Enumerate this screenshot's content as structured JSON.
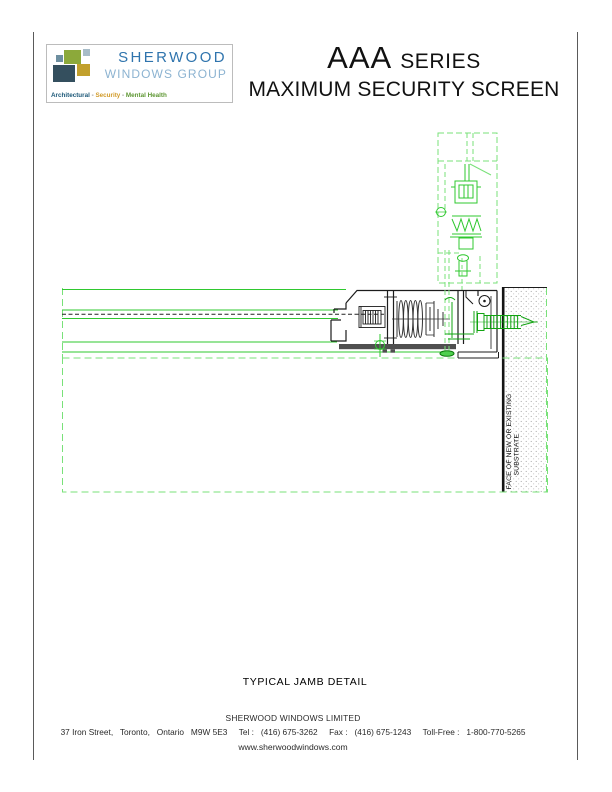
{
  "logo": {
    "brand_line1": "SHERWOOD",
    "brand_line2": "WINDOWS GROUP",
    "tagline": {
      "a": "Architectural",
      "s1": " - ",
      "b": "Security",
      "s2": " - ",
      "c": "Mental Health"
    },
    "colors": {
      "brand1": "#2f74ad",
      "brand2": "#8cb3d1",
      "tag_architectural": "#1c5878",
      "tag_security": "#d19a28",
      "tag_mental_health": "#5e9733",
      "square_green": "#8ca93a",
      "square_slate": "#344f5e",
      "square_gold": "#c2a02c",
      "square_steel": "#6e8fa0",
      "square_pale": "#a8bcc8"
    }
  },
  "header": {
    "series_main": "AAA",
    "series_suffix": "SERIES",
    "subtitle": "MAXIMUM SECURITY SCREEN"
  },
  "drawing": {
    "caption": "TYPICAL JAMB DETAIL",
    "substrate_label_line1": "FACE OF NEW OR EXISTING",
    "substrate_label_line2": "SUBSTRATE",
    "colors": {
      "dashed_green": "#79e179",
      "solid_green": "#2fc82f",
      "dark_green": "#12a412",
      "line_black": "#1c1c1c",
      "profile_gray": "#4f4f4f",
      "stipple_gray": "#9a9a9a"
    }
  },
  "footer": {
    "company": "SHERWOOD WINDOWS LIMITED",
    "address": "37 Iron Street,   Toronto,   Ontario   M9W 5E3     Tel :   (416) 675-3262     Fax :   (416) 675-1243     Toll-Free :   1-800-770-5265",
    "website": "www.sherwoodwindows.com"
  }
}
